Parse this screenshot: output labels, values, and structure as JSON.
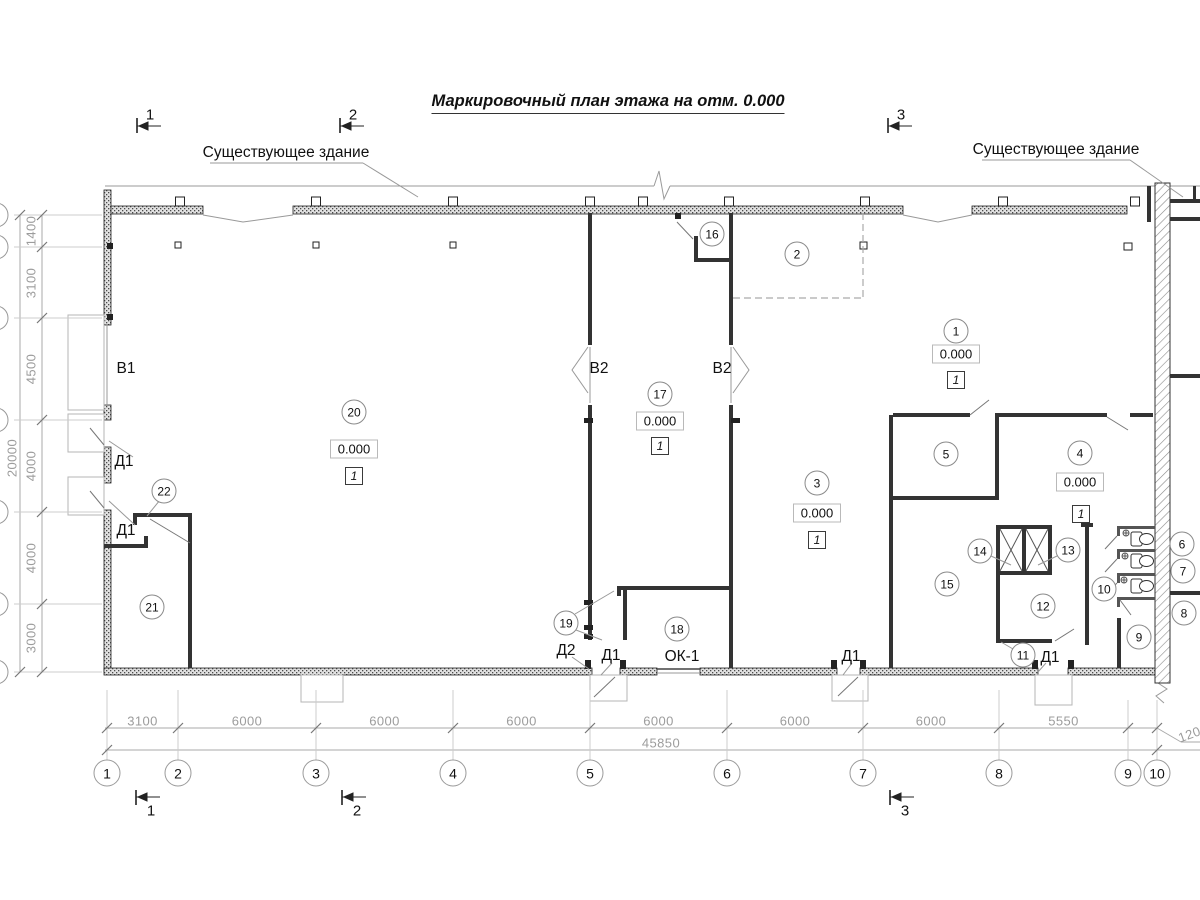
{
  "title": "Маркировочный план этажа на отм. 0.000",
  "annotations": {
    "existing_building_left": "Существующее здание",
    "existing_building_right": "Существующее здание",
    "window": "ОК-1"
  },
  "gates": [
    {
      "id": "b1",
      "label": "В1"
    },
    {
      "id": "b2-left",
      "label": "В2"
    },
    {
      "id": "b2-right",
      "label": "В2"
    }
  ],
  "doors": [
    {
      "id": "d1-left-upper",
      "label": "Д1"
    },
    {
      "id": "d1-left-lower",
      "label": "Д1"
    },
    {
      "id": "d2-bottom",
      "label": "Д2"
    },
    {
      "id": "d1-bottom-axis5",
      "label": "Д1"
    },
    {
      "id": "d1-bottom-axis7",
      "label": "Д1"
    },
    {
      "id": "d1-bottom-axis8",
      "label": "Д1"
    }
  ],
  "rooms": [
    "1",
    "2",
    "3",
    "4",
    "5",
    "6",
    "7",
    "8",
    "9",
    "10",
    "11",
    "12",
    "13",
    "14",
    "15",
    "16",
    "17",
    "18",
    "19",
    "20",
    "21",
    "22"
  ],
  "elevation_marks": [
    {
      "room": "20",
      "value": "0.000",
      "floor_type": "1"
    },
    {
      "room": "17",
      "value": "0.000",
      "floor_type": "1"
    },
    {
      "room": "3",
      "value": "0.000",
      "floor_type": "1"
    },
    {
      "room": "1",
      "value": "0.000",
      "floor_type": "1"
    },
    {
      "room": "4",
      "value": "0.000",
      "floor_type": "1"
    }
  ],
  "axes": {
    "bottom": [
      "1",
      "2",
      "3",
      "4",
      "5",
      "6",
      "7",
      "8",
      "9",
      "10"
    ]
  },
  "dimensions": {
    "bottom_segments": [
      "3100",
      "6000",
      "6000",
      "6000",
      "6000",
      "6000",
      "6000",
      "5550"
    ],
    "bottom_offset": "1200",
    "bottom_total": "45850",
    "left_segments": [
      "1400",
      "3100",
      "4500",
      "4000",
      "4000",
      "3000"
    ],
    "left_total": "20000"
  },
  "section_marks": {
    "top": [
      "1",
      "2",
      "3"
    ],
    "bottom": [
      "1",
      "2",
      "3"
    ]
  },
  "colors": {
    "wall": "#333333",
    "dim_text": "#9c9c9c",
    "line": "#999999",
    "text": "#111111"
  }
}
